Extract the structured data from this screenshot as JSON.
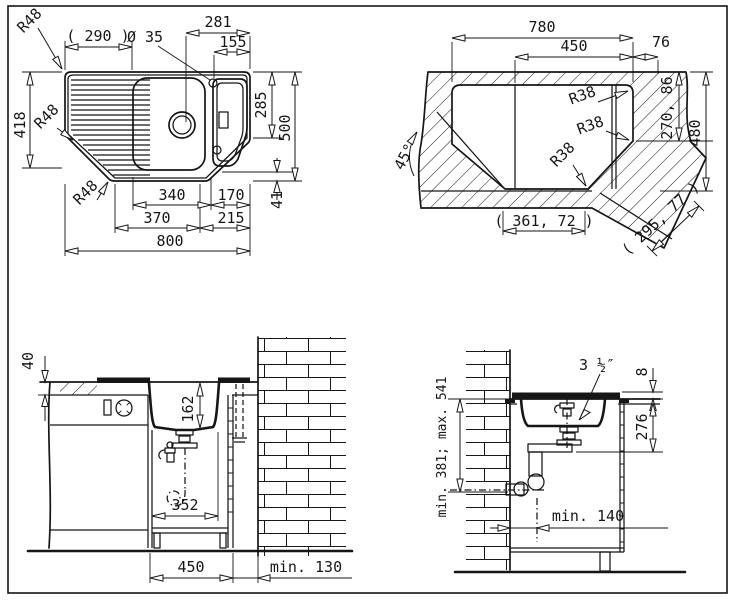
{
  "figure": {
    "kind": "sink installation technical drawing",
    "ink_color": "#161616",
    "paper_color": "#ffffff"
  },
  "views": {
    "plan": {
      "name": "sink plan view",
      "d290": "( 290 )",
      "d281": "281",
      "d155": "155",
      "d35": "Ø 35",
      "r48a": "R48",
      "r48b": "R48",
      "r48c": "R48",
      "d418": "418",
      "d285": "285",
      "d500": "500",
      "d41": "41",
      "d340": "340",
      "d170": "170",
      "d370": "370",
      "d215": "215",
      "d800": "800"
    },
    "cutout": {
      "name": "worktop cutout view",
      "d780": "780",
      "d450": "450",
      "d76": "76",
      "r38a": "R38",
      "r38b": "R38",
      "r38c": "R38",
      "a45": "45°",
      "d270": "270, 86",
      "d480": "480",
      "d361": "( 361, 72 )",
      "d295": "( 295, 77 )"
    },
    "front_section": {
      "name": "front installation section",
      "d40": "40",
      "d162": "162",
      "d352": "352",
      "d450": "450",
      "d130": "min. 130"
    },
    "side_section": {
      "name": "side installation section",
      "ddrain": "3 ½″",
      "d8": "8",
      "d276": "276",
      "d381": "min. 381; max. 541",
      "d140": "min. 140"
    }
  }
}
